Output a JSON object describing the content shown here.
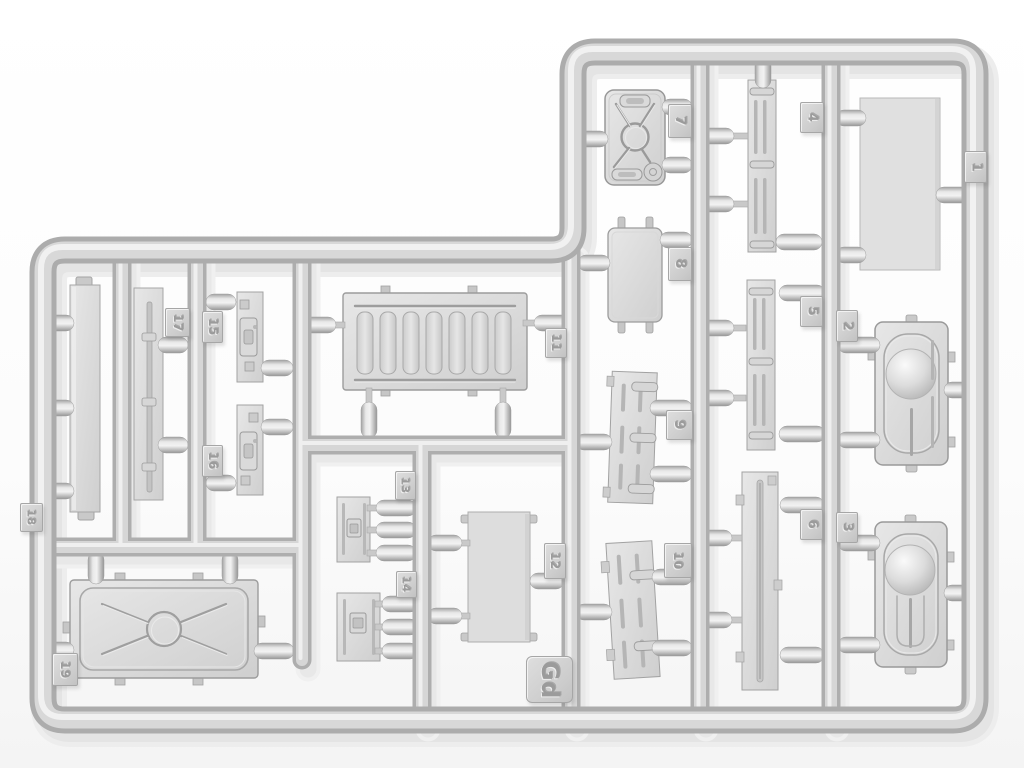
{
  "colors": {
    "background": "#fbfbfb",
    "plastic_light": "#efefef",
    "plastic_mid": "#d6d6d6",
    "plastic_edge": "#a8a8a8"
  },
  "sprue": {
    "code_label": "Gd",
    "tags": [
      {
        "number": "1"
      },
      {
        "number": "2"
      },
      {
        "number": "3"
      },
      {
        "number": "4"
      },
      {
        "number": "5"
      },
      {
        "number": "6"
      },
      {
        "number": "7"
      },
      {
        "number": "8"
      },
      {
        "number": "9"
      },
      {
        "number": "10"
      },
      {
        "number": "11"
      },
      {
        "number": "12"
      },
      {
        "number": "13"
      },
      {
        "number": "14"
      },
      {
        "number": "15"
      },
      {
        "number": "16"
      },
      {
        "number": "17"
      },
      {
        "number": "18"
      },
      {
        "number": "19"
      }
    ]
  }
}
